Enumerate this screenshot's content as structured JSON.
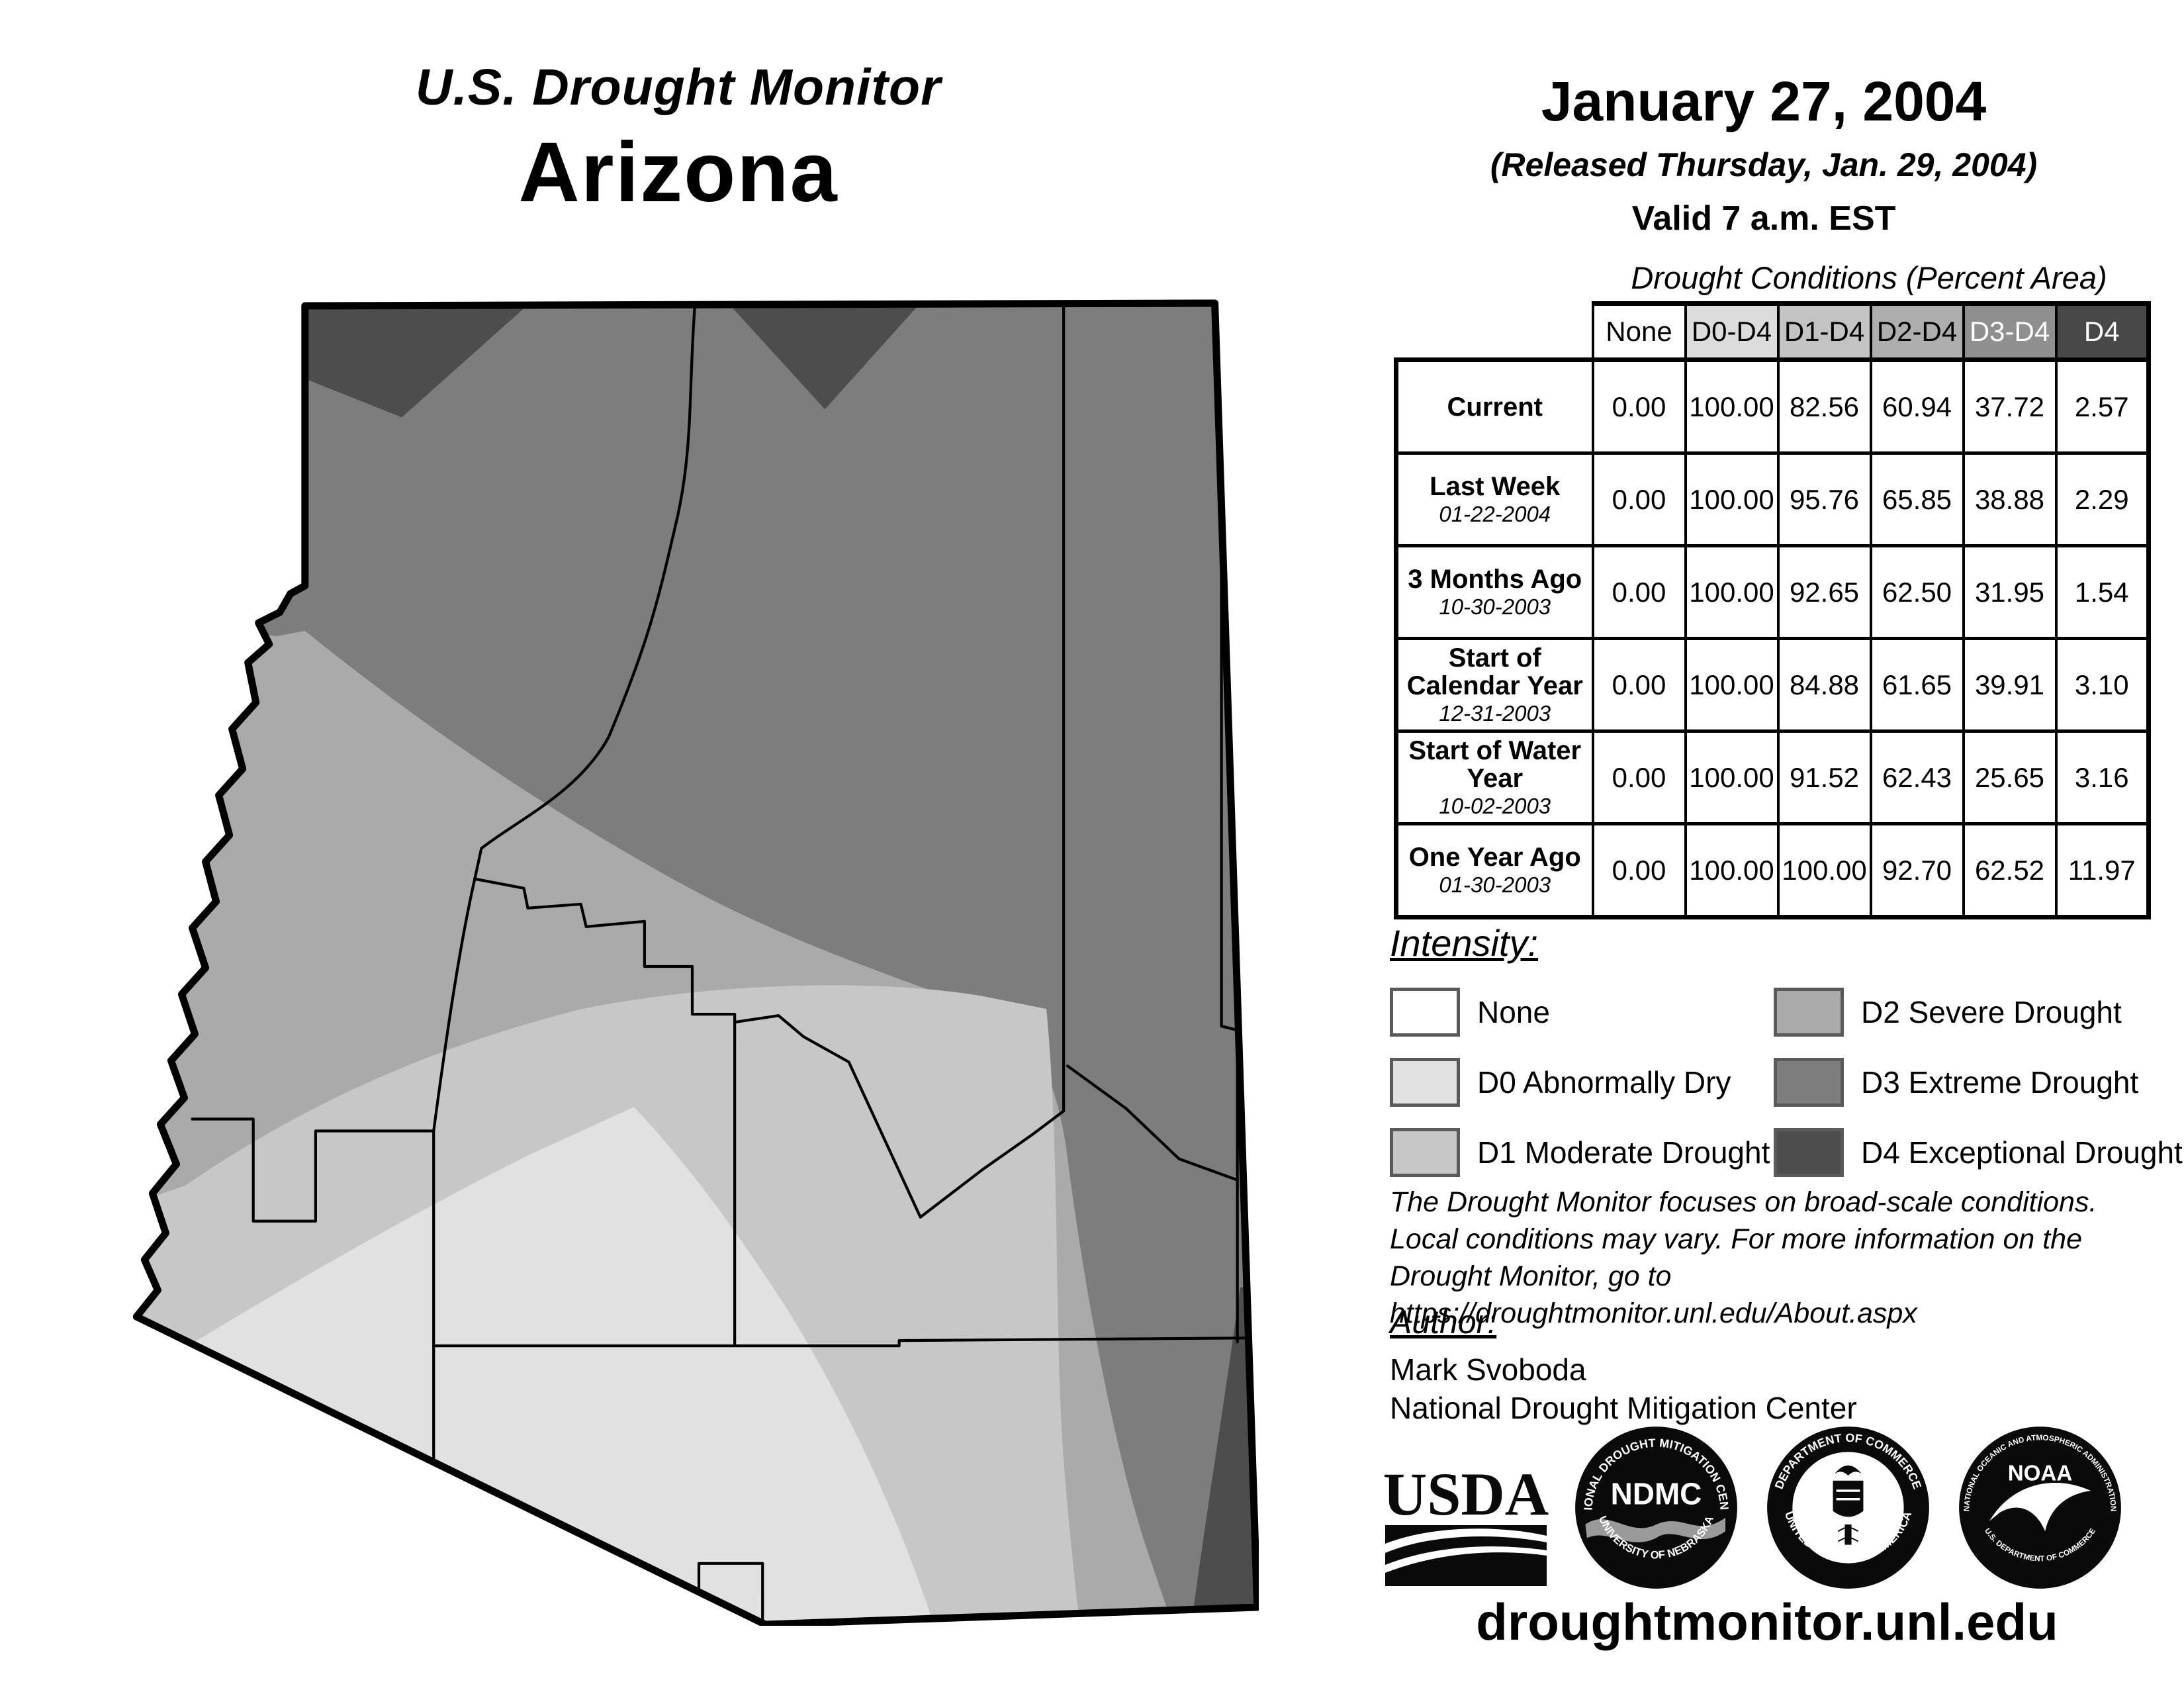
{
  "header": {
    "title_line1": "U.S. Drought Monitor",
    "title_line2": "Arizona",
    "date": "January 27, 2004",
    "released": "(Released Thursday, Jan. 29, 2004)",
    "valid": "Valid 7 a.m. EST"
  },
  "table": {
    "title": "Drought Conditions (Percent Area)",
    "col_headers": [
      "None",
      "D0-D4",
      "D1-D4",
      "D2-D4",
      "D3-D4",
      "D4"
    ],
    "rows": [
      {
        "label": "Current",
        "date": "",
        "values": [
          "0.00",
          "100.00",
          "82.56",
          "60.94",
          "37.72",
          "2.57"
        ]
      },
      {
        "label": "Last Week",
        "date": "01-22-2004",
        "values": [
          "0.00",
          "100.00",
          "95.76",
          "65.85",
          "38.88",
          "2.29"
        ]
      },
      {
        "label": "3 Months Ago",
        "date": "10-30-2003",
        "values": [
          "0.00",
          "100.00",
          "92.65",
          "62.50",
          "31.95",
          "1.54"
        ]
      },
      {
        "label": "Start of Calendar Year",
        "date": "12-31-2003",
        "values": [
          "0.00",
          "100.00",
          "84.88",
          "61.65",
          "39.91",
          "3.10"
        ]
      },
      {
        "label": "Start of Water Year",
        "date": "10-02-2003",
        "values": [
          "0.00",
          "100.00",
          "91.52",
          "62.43",
          "25.65",
          "3.16"
        ]
      },
      {
        "label": "One Year Ago",
        "date": "01-30-2003",
        "values": [
          "0.00",
          "100.00",
          "100.00",
          "92.70",
          "62.52",
          "11.97"
        ]
      }
    ]
  },
  "legend": {
    "heading": "Intensity:",
    "items": [
      {
        "code": "none",
        "label": "None"
      },
      {
        "code": "d0",
        "label": "D0 Abnormally Dry"
      },
      {
        "code": "d1",
        "label": "D1 Moderate Drought"
      },
      {
        "code": "d2",
        "label": "D2 Severe Drought"
      },
      {
        "code": "d3",
        "label": "D3 Extreme Drought"
      },
      {
        "code": "d4",
        "label": "D4 Exceptional Drought"
      }
    ]
  },
  "disclaimer": {
    "line1": "The Drought Monitor focuses on broad-scale conditions.",
    "line2": "Local conditions may vary. For more information on the",
    "line3": "Drought Monitor, go to https://droughtmonitor.unl.edu/About.aspx"
  },
  "author": {
    "heading": "Author:",
    "name": "Mark Svoboda",
    "org": "National Drought Mitigation Center"
  },
  "logos": {
    "usda": "USDA",
    "ndmc_center": "NDMC",
    "ndmc_top": "NATIONAL DROUGHT MITIGATION CENTER",
    "ndmc_bottom": "UNIVERSITY OF NEBRASKA",
    "doc_top": "DEPARTMENT OF COMMERCE",
    "doc_bottom": "UNITED STATES OF AMERICA",
    "noaa": "NOAA",
    "noaa_top": "NATIONAL OCEANIC AND ATMOSPHERIC ADMINISTRATION",
    "noaa_bottom": "U.S. DEPARTMENT OF COMMERCE"
  },
  "footer": {
    "url": "droughtmonitor.unl.edu"
  },
  "map": {
    "state": "Arizona",
    "colors": {
      "none": "#ffffff",
      "d0": "#e1e1e1",
      "d1": "#c7c7c7",
      "d2": "#aaaaaa",
      "d3": "#7d7d7d",
      "d4": "#4d4d4d"
    },
    "header_colors": {
      "none": "#ffffff",
      "d0": "#dcdcdc",
      "d1": "#c3c3c3",
      "d2": "#aeaeae",
      "d3": "#8f8f8f",
      "d4": "#484848"
    }
  }
}
